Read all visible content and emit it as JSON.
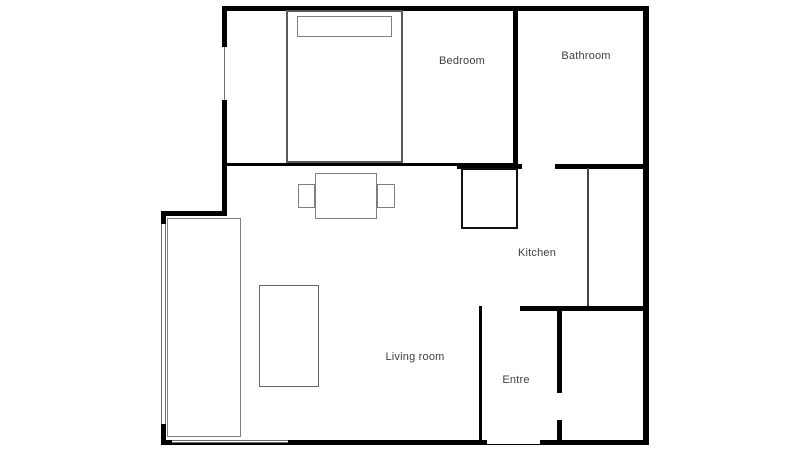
{
  "floorplan": {
    "rooms": {
      "bedroom": {
        "label": "Bedroom"
      },
      "bathroom": {
        "label": "Bathroom"
      },
      "kitchen": {
        "label": "Kitchen"
      },
      "living_room": {
        "label": "Living room"
      },
      "entre": {
        "label": "Entre"
      }
    },
    "fixtures": [
      "bed",
      "pillow",
      "dining-table",
      "dining-chair-left",
      "dining-chair-right",
      "kitchen-appliance",
      "kitchen-counter",
      "wardrobe",
      "coffee-table",
      "window-left-bedroom",
      "window-left-living",
      "window-bottom",
      "entrance-door-opening",
      "bathroom-door-opening",
      "entre-opening",
      "closet-door-opening"
    ],
    "colors": {
      "wall": "#000000",
      "furniture_outline": "#7f7f7f",
      "text": "#3f3f3f",
      "background": "#ffffff"
    }
  }
}
